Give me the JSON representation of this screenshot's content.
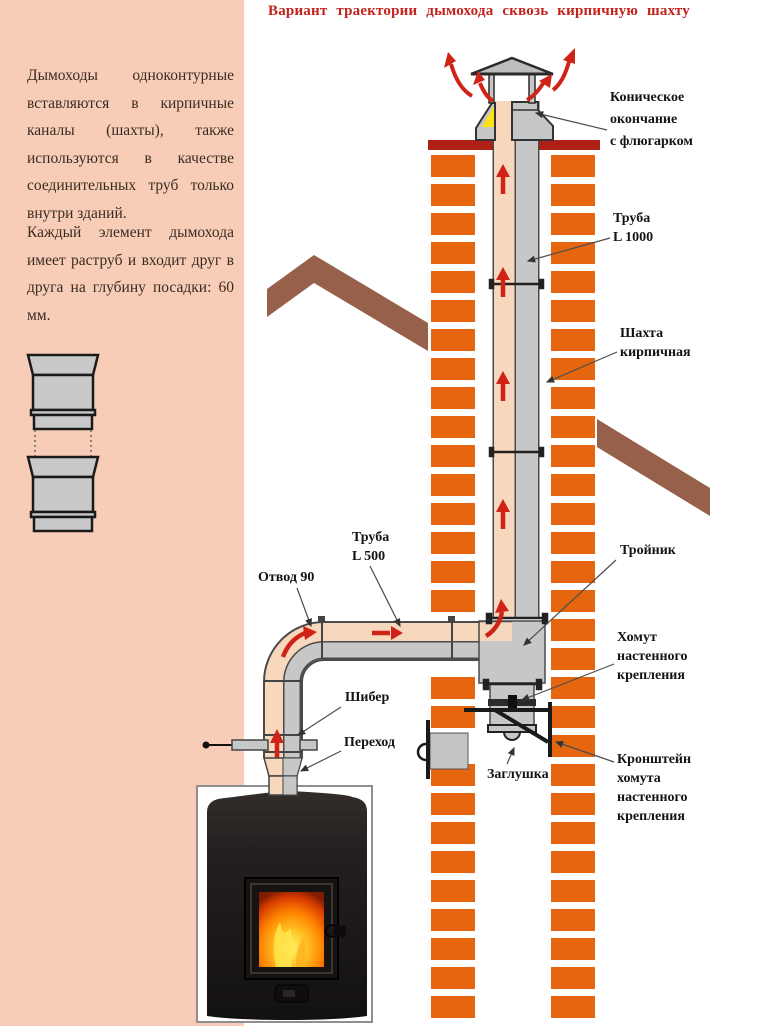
{
  "title": "Вариант траектории дымохода сквозь кирпичную шахту",
  "sidebar": {
    "paragraphs": [
      "Дымоходы одноконтурные вставляются в кирпичные каналы (шахты), также используются в качестве соединительных труб только внутри зданий.",
      "Каждый элемент дымохода имеет раструб и входит друг в друга на глубину посадки: 60 мм."
    ]
  },
  "diagram": {
    "labels": {
      "cap": "Коническое\nокончание\nс флюгарком",
      "pipe1000": "Труба\nL 1000",
      "shaft": "Шахта\nкирпичная",
      "pipe500": "Труба\nL 500",
      "elbow": "Отвод 90",
      "tee": "Тройник",
      "clamp": "Хомут\nнастенного\nкрепления",
      "bracket": "Кронштейн\nхомута\nнастенного\nкрепления",
      "plug": "Заглушка",
      "damper": "Шибер",
      "adapter": "Переход"
    },
    "colors": {
      "panel": "#f8cdb7",
      "brick": "#e5660e",
      "pipe_inner": "#f7d8bd",
      "pipe_gray": "#c7c7c7",
      "flow_arrow_red": "#d02318",
      "roof_brown": "#96604a",
      "chimney_band_red": "#b01f16",
      "title_red": "#c2231c",
      "flue_highlight_yellow": "#ffe212"
    }
  }
}
